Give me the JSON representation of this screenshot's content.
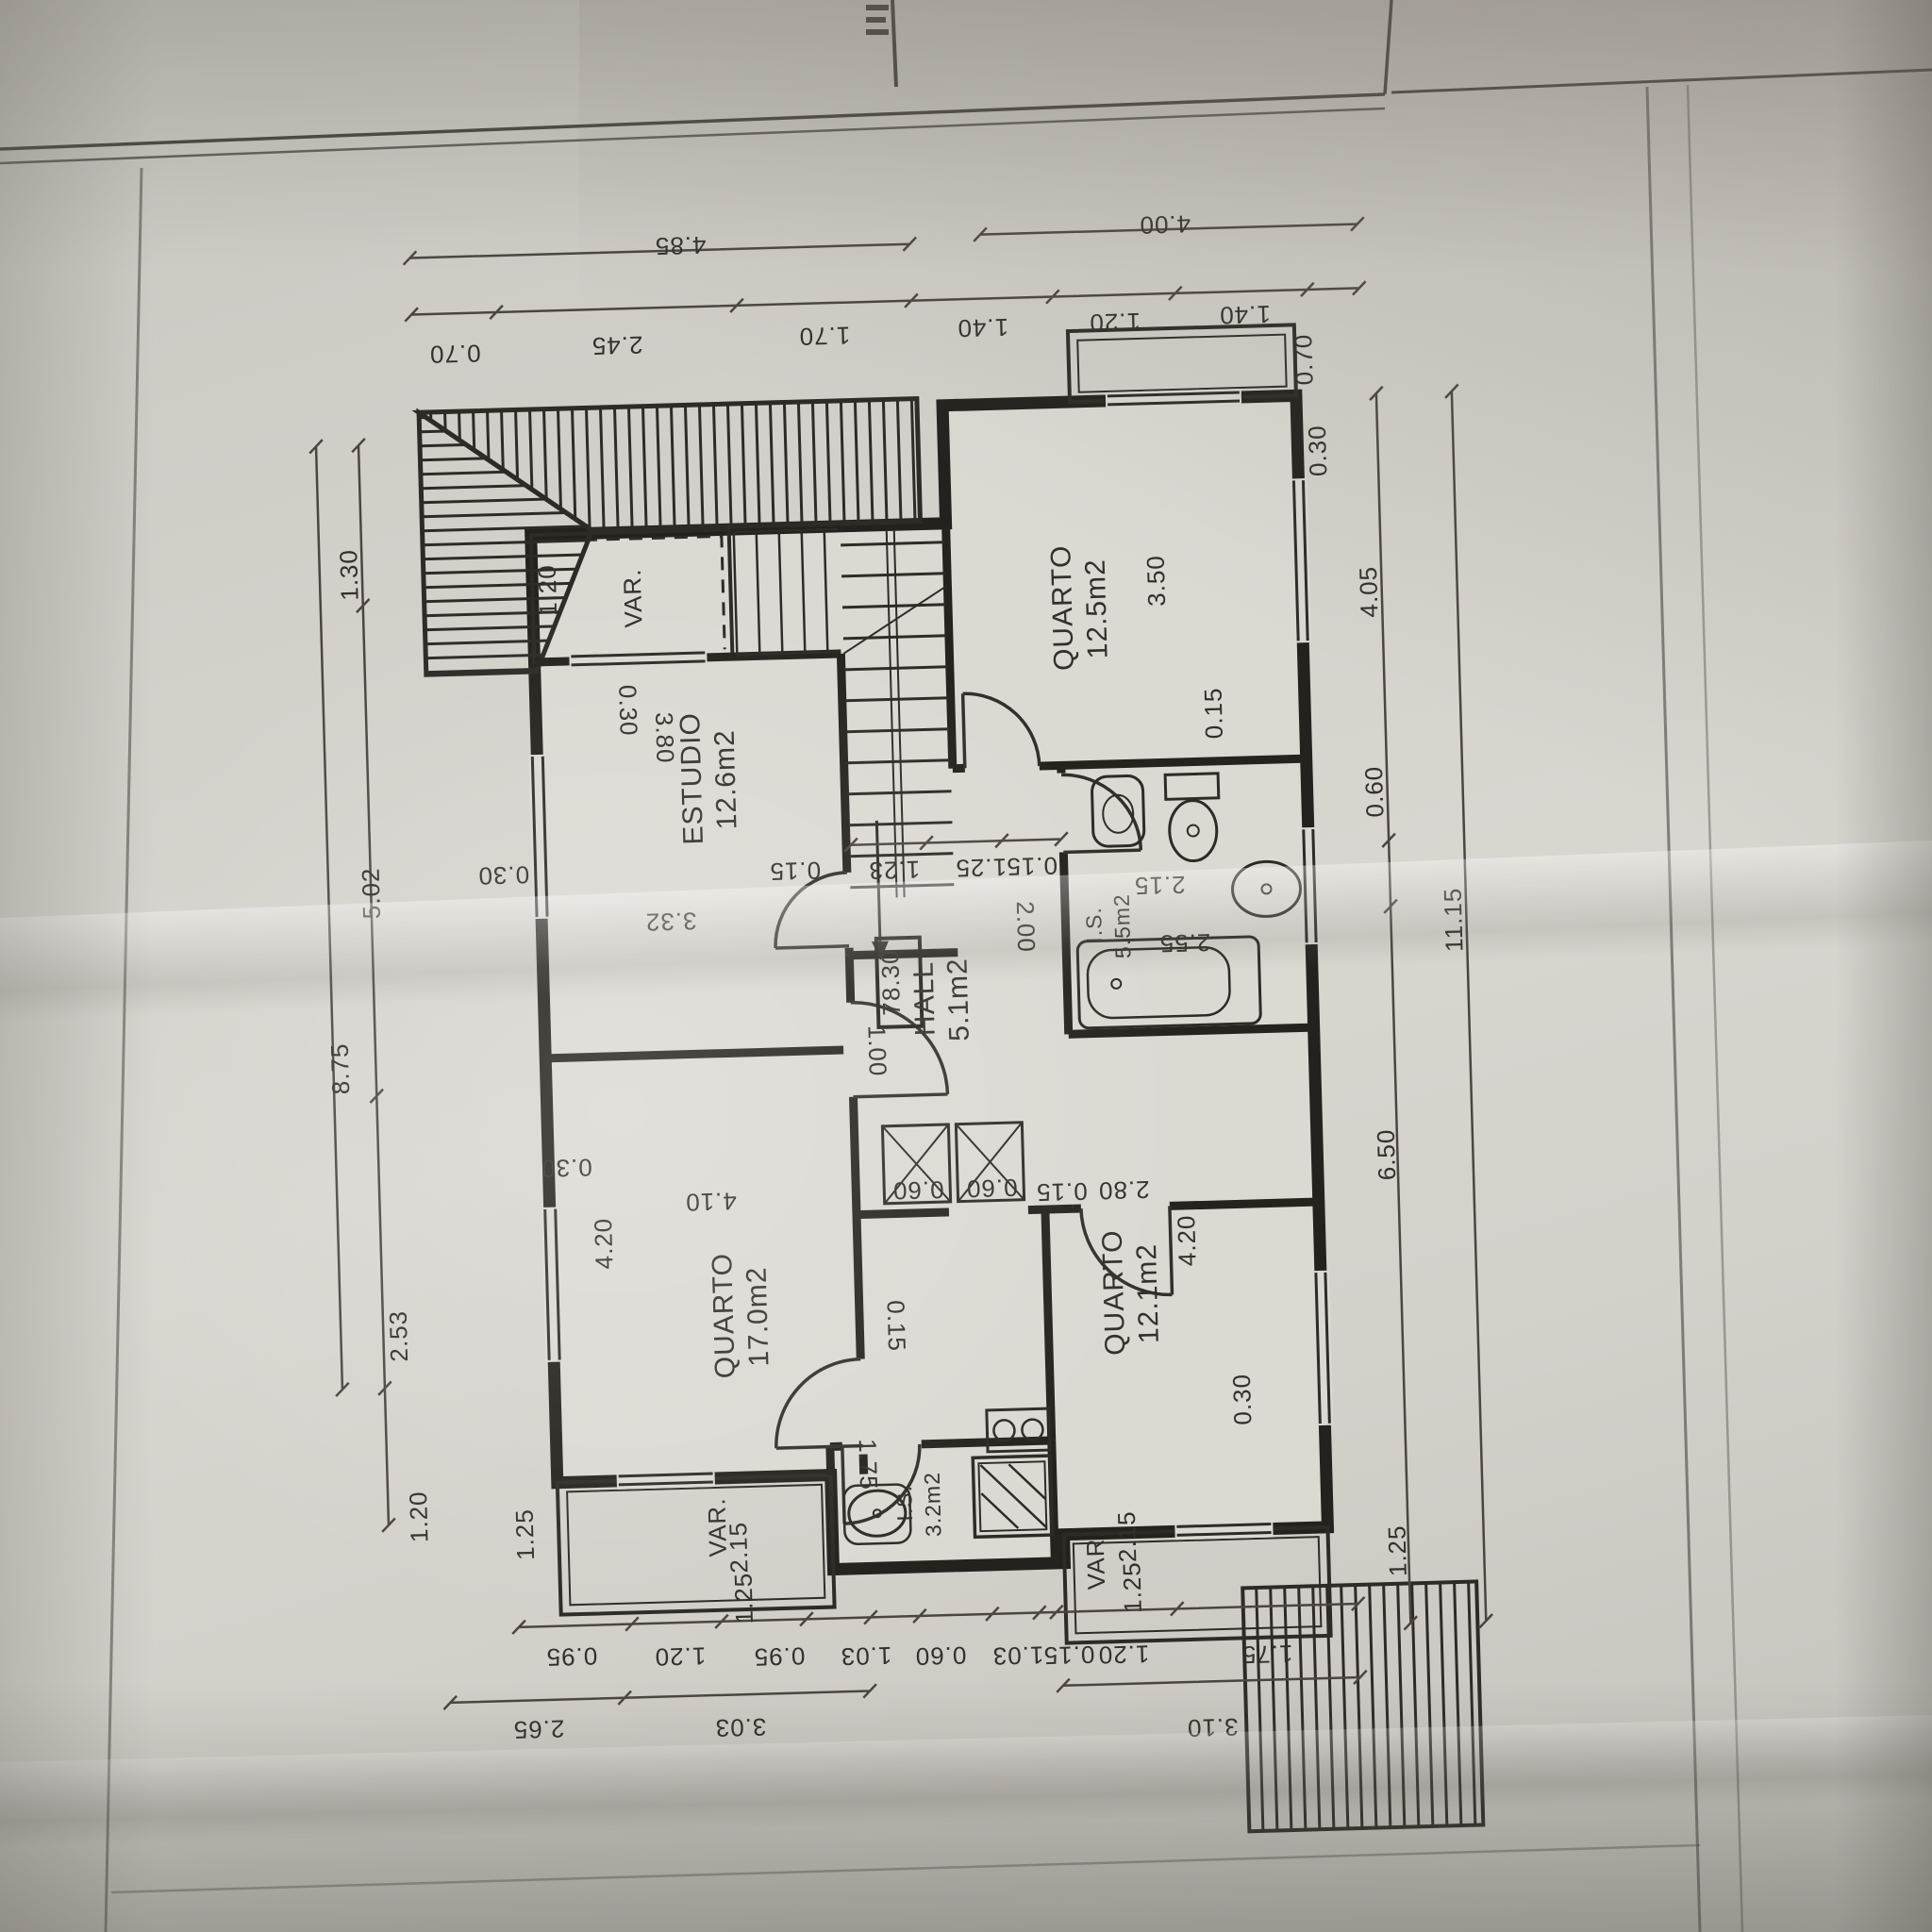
{
  "labels": {
    "quarto1_name": "QUARTO",
    "quarto1_area": "12.5m2",
    "quarto2_name": "QUARTO",
    "quarto2_area": "17.0m2",
    "quarto3_name": "QUARTO",
    "quarto3_area": "12.1m2",
    "estudio_name": "ESTUDIO",
    "estudio_area": "12.6m2",
    "hall_name": "HALL",
    "hall_area": "5.1m2",
    "is1_name": "I.S.",
    "is1_area": "5.5m2",
    "is2_name": "I.S.",
    "is2_area": "3.2m2",
    "var_top": "VAR.",
    "var_bottom_left": "VAR.",
    "var_bottom_right": "VAR.",
    "level": "78.30"
  },
  "dims": {
    "top_outer": [
      "4.85",
      "4.00"
    ],
    "top_inner": [
      "0.70",
      "2.45",
      "1.70",
      "1.40",
      "1.20",
      "1.40"
    ],
    "left_col": [
      "1.30",
      "5.02",
      "2.53",
      "1.20"
    ],
    "left_total": "8.75",
    "left_wall": [
      "0.30",
      "1.25",
      "1.20"
    ],
    "right_col": [
      "4.05",
      "0.60",
      "6.50"
    ],
    "right_total": "11.15",
    "right_wall": [
      "0.70",
      "0.30",
      "1.25"
    ],
    "bottom_row1": [
      "0.95",
      "1.20",
      "0.95",
      "1.03",
      "0.60",
      "1.03",
      "0.15",
      "1.20",
      "1.75"
    ],
    "bottom_row2": [
      "2.65",
      "3.03",
      "3.10"
    ],
    "estudio": [
      "3.32",
      "0.30",
      "3.80",
      "0.15"
    ],
    "quarto1": [
      "3.50",
      "0.15"
    ],
    "hall": [
      "2.00",
      "1.00",
      "0.15",
      "1.23",
      "1.25"
    ],
    "is1": [
      "2.15",
      "2.55"
    ],
    "quarto2": [
      "4.20",
      "4.10",
      "0.30",
      "0.15"
    ],
    "quarto3": [
      "4.20",
      "2.80",
      "0.30",
      "0.15"
    ],
    "is2": [
      "1.75"
    ],
    "closets": [
      "0.60",
      "0.60"
    ],
    "var_left": [
      "2.15",
      "1.25"
    ],
    "var_right": [
      "2.15",
      "1.25"
    ]
  }
}
